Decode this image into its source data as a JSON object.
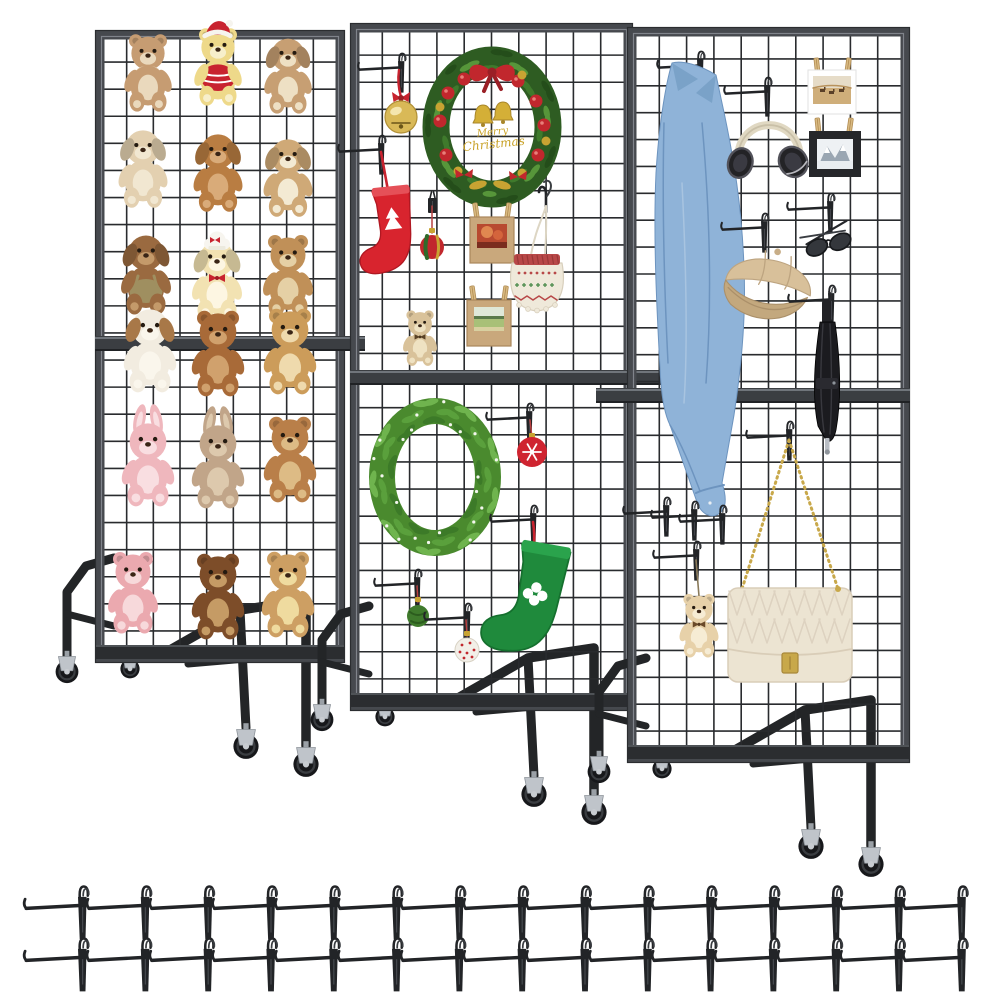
{
  "meta": {
    "description": "Product photo: three rolling grid-wall display panel stands with merchandise and two rows of grid hooks",
    "background": "#ffffff"
  },
  "colors": {
    "frame": "#46494e",
    "frame_hi": "#868b92",
    "frame_dark": "#2b2d30",
    "grid": "#292b2e",
    "bar": "#3b3e42",
    "bar_hi": "#70757b",
    "base": "#232527",
    "tire": "#17181b",
    "fork": "#bfc4ca",
    "hook": "#222427",
    "red": "#c8232f",
    "gold": "#c9a227",
    "denim": "#8fb3d8",
    "khaki": "#d8c09a",
    "cream_bag": "#ece4d2",
    "wreath_green": "#4a8a2e"
  },
  "stands": [
    {
      "name": "grid-panel-stand-left",
      "panel": {
        "x": 100,
        "y": 35,
        "w": 240,
        "h": 623,
        "midY": 336,
        "barEnd": 365
      },
      "items": [
        {
          "t": "plush",
          "n": "teddy-bear-tan",
          "kind": "bear",
          "p": [
            148,
            77
          ],
          "s": 0.95,
          "c": {
            "fur": "#c69c72",
            "muz": "#ead9bd"
          },
          "acc": {
            "ruff": "#ecdfc8"
          }
        },
        {
          "t": "plush",
          "n": "teddy-bear-yellow-santa",
          "kind": "bear",
          "p": [
            218,
            71
          ],
          "s": 0.95,
          "c": {
            "fur": "#eed98a",
            "muz": "#f7efcb"
          },
          "acc": {
            "hat": "santa",
            "sweater": "#c8232f"
          }
        },
        {
          "t": "plush",
          "n": "puppy-plush-light-brown",
          "kind": "dog",
          "p": [
            288,
            79
          ],
          "s": 0.95,
          "c": {
            "fur": "#c79f73",
            "muz": "#eee0c4"
          }
        },
        {
          "t": "plush",
          "n": "puppy-plush-cream",
          "kind": "dog",
          "p": [
            143,
            172
          ],
          "s": 0.98,
          "c": {
            "fur": "#e3d0b0",
            "muz": "#f1e7d1"
          }
        },
        {
          "t": "plush",
          "n": "puppy-plush-caramel",
          "kind": "dog",
          "p": [
            218,
            176
          ],
          "s": 0.98,
          "c": {
            "fur": "#b97d42",
            "muz": "#d9ab79"
          }
        },
        {
          "t": "plush",
          "n": "puppy-plush-tan",
          "kind": "dog",
          "p": [
            288,
            181
          ],
          "s": 0.98,
          "c": {
            "fur": "#cfa977",
            "muz": "#f3ead3"
          }
        },
        {
          "t": "plush",
          "n": "puppy-plush-overalls",
          "kind": "dog",
          "p": [
            146,
            278
          ],
          "s": 1.0,
          "c": {
            "fur": "#9a6a40",
            "muz": "#c49a6a"
          },
          "acc": {
            "overalls": "#9f8f60"
          }
        },
        {
          "t": "plush",
          "n": "puppy-plush-chef-hat",
          "kind": "dog",
          "p": [
            217,
            284
          ],
          "s": 1.0,
          "c": {
            "fur": "#f2e2b2",
            "muz": "#fdf6e2"
          },
          "acc": {
            "hat": "chef",
            "bowtie": "#c8232f"
          }
        },
        {
          "t": "plush",
          "n": "teddy-bear-caramel",
          "kind": "bear",
          "p": [
            288,
            280
          ],
          "s": 1.0,
          "c": {
            "fur": "#c09058",
            "muz": "#e5d0a5"
          }
        },
        {
          "t": "plush",
          "n": "puppy-plush-white",
          "kind": "dog",
          "p": [
            150,
            354
          ],
          "s": 1.05,
          "c": {
            "fur": "#f2ece0",
            "muz": "#faf6ec",
            "ear": "#a87848"
          }
        },
        {
          "t": "plush",
          "n": "teddy-bear-brown",
          "kind": "bear",
          "p": [
            218,
            358
          ],
          "s": 1.05,
          "c": {
            "fur": "#a86a38",
            "muz": "#d0a16d"
          }
        },
        {
          "t": "plush",
          "n": "teddy-bear-golden",
          "kind": "bear",
          "p": [
            290,
            356
          ],
          "s": 1.05,
          "c": {
            "fur": "#cc9c5a",
            "muz": "#efdaad"
          }
        },
        {
          "t": "plush",
          "n": "bunny-plush-pink",
          "kind": "bunny",
          "p": [
            148,
            468
          ],
          "s": 1.05,
          "c": {
            "fur": "#efb7bd",
            "muz": "#f9dee1"
          }
        },
        {
          "t": "plush",
          "n": "bunny-plush-taupe",
          "kind": "bunny",
          "p": [
            218,
            470
          ],
          "s": 1.05,
          "c": {
            "fur": "#c1a589",
            "muz": "#ddc9ad"
          }
        },
        {
          "t": "plush",
          "n": "teddy-bear-russet",
          "kind": "bear",
          "p": [
            290,
            464
          ],
          "s": 1.05,
          "c": {
            "fur": "#b97f49",
            "muz": "#ddbb85"
          }
        },
        {
          "t": "plush",
          "n": "teddy-bear-pink",
          "kind": "bear",
          "p": [
            133,
            597
          ],
          "s": 1.0,
          "c": {
            "fur": "#eba9af",
            "muz": "#f7d9db"
          }
        },
        {
          "t": "plush",
          "n": "teddy-bear-dark-brown",
          "kind": "bear",
          "p": [
            218,
            601
          ],
          "s": 1.05,
          "c": {
            "fur": "#7d4d29",
            "muz": "#c59b65"
          }
        },
        {
          "t": "plush",
          "n": "teddy-bear-honey",
          "kind": "bear",
          "p": [
            288,
            599
          ],
          "s": 1.05,
          "c": {
            "fur": "#cd9f63",
            "muz": "#efdb9f"
          }
        }
      ]
    },
    {
      "name": "grid-panel-stand-middle",
      "panel": {
        "x": 355,
        "y": 28,
        "w": 273,
        "h": 678,
        "midY": 370,
        "barEnd": 703
      },
      "items": [
        {
          "t": "hook",
          "n": "grid-hook",
          "p": [
            398,
            62
          ]
        },
        {
          "t": "bell",
          "n": "gold-jingle-bell",
          "p": [
            401,
            117
          ],
          "anchor": [
            399,
            70
          ]
        },
        {
          "t": "wreath-xmas",
          "n": "christmas-wreath",
          "p": [
            492,
            127
          ],
          "text": [
            "Merry",
            "Christmas"
          ]
        },
        {
          "t": "hook",
          "n": "grid-hook",
          "p": [
            378,
            144
          ]
        },
        {
          "t": "ribbon",
          "n": "red-ribbon",
          "from": [
            381,
            152
          ],
          "to": [
            389,
            196
          ]
        },
        {
          "t": "stocking",
          "n": "red-christmas-stocking",
          "p": [
            391,
            236
          ],
          "s": 1.1,
          "rot": -6,
          "c": {
            "body": "#d8242e",
            "cuff": "#e55058",
            "line": "#b01822"
          },
          "cut": "tree"
        },
        {
          "t": "clip",
          "n": "grid-clip",
          "p": [
            428,
            198
          ]
        },
        {
          "t": "ornament-striped",
          "n": "striped-ornament",
          "p": [
            432,
            247
          ],
          "anchor": [
            432,
            206
          ]
        },
        {
          "t": "photo-frame",
          "n": "kraft-photo-frame-autumn",
          "p": [
            492,
            240
          ],
          "photo": "autumn"
        },
        {
          "t": "s-hook",
          "n": "s-hook",
          "p": [
            546,
            198
          ]
        },
        {
          "t": "knit-bag",
          "n": "knit-drawstring-bag",
          "p": [
            537,
            283
          ]
        },
        {
          "t": "plush",
          "n": "mini-teddy-bear",
          "kind": "bear",
          "p": [
            420,
            341
          ],
          "s": 0.68,
          "c": {
            "fur": "#d9c29a",
            "muz": "#efe2c2"
          },
          "acc": {
            "bowtie": "#5a4226"
          }
        },
        {
          "t": "photo-frame",
          "n": "kraft-photo-frame-field",
          "p": [
            489,
            323
          ],
          "photo": "field"
        },
        {
          "t": "wreath-green",
          "n": "green-leaf-wreath",
          "p": [
            435,
            477
          ]
        },
        {
          "t": "hook",
          "n": "grid-hook",
          "p": [
            526,
            412
          ]
        },
        {
          "t": "ornament-snow",
          "n": "red-snowflake-ornament",
          "p": [
            532,
            452
          ],
          "anchor": [
            530,
            420
          ]
        },
        {
          "t": "hook",
          "n": "grid-hook",
          "p": [
            530,
            514
          ]
        },
        {
          "t": "ribbon",
          "n": "red-ribbon",
          "from": [
            533,
            522
          ],
          "to": [
            528,
            572
          ]
        },
        {
          "t": "stocking",
          "n": "green-christmas-stocking",
          "p": [
            530,
            607
          ],
          "s": 1.45,
          "rot": 10,
          "c": {
            "body": "#1f8a3c",
            "cuff": "#2aa34c",
            "line": "#15702e"
          },
          "cut": "clover"
        },
        {
          "t": "hook",
          "n": "grid-hook",
          "p": [
            414,
            578
          ]
        },
        {
          "t": "ornament-plain",
          "n": "green-ball-ornament",
          "p": [
            418,
            616
          ],
          "anchor": [
            417,
            586
          ]
        },
        {
          "t": "hook",
          "n": "grid-hook",
          "p": [
            464,
            612
          ]
        },
        {
          "t": "ornament-dots",
          "n": "white-red-dot-ornament",
          "p": [
            467,
            650
          ],
          "anchor": [
            466,
            620
          ]
        }
      ]
    },
    {
      "name": "grid-panel-stand-right",
      "panel": {
        "x": 632,
        "y": 32,
        "w": 273,
        "h": 726,
        "midY": 388,
        "barStart": 596
      },
      "items": [
        {
          "t": "hook",
          "n": "grid-hook",
          "p": [
            697,
            60
          ]
        },
        {
          "t": "denim-shirt",
          "n": "denim-shirt",
          "p": [
            672,
            63
          ]
        },
        {
          "t": "hook",
          "n": "grid-hook",
          "p": [
            764,
            86
          ]
        },
        {
          "t": "headphones",
          "n": "headphones",
          "p": [
            769,
            132
          ],
          "s": 1.15
        },
        {
          "t": "photo-card",
          "n": "photo-card-desert",
          "p": [
            832,
            92
          ]
        },
        {
          "t": "photo-black",
          "n": "framed-photo-mountain",
          "p": [
            835,
            154
          ]
        },
        {
          "t": "hook",
          "n": "grid-hook",
          "p": [
            827,
            202
          ]
        },
        {
          "t": "sunglasses",
          "n": "sunglasses",
          "p": [
            828,
            243
          ]
        },
        {
          "t": "hook",
          "n": "grid-hook",
          "p": [
            761,
            222
          ]
        },
        {
          "t": "cap",
          "n": "baseball-cap",
          "p": [
            770,
            276
          ],
          "s": 1.1
        },
        {
          "t": "hook",
          "n": "grid-hook",
          "p": [
            828,
            294
          ]
        },
        {
          "t": "umbrella",
          "n": "folded-umbrella",
          "p": [
            827,
            382
          ]
        },
        {
          "t": "hook",
          "n": "grid-hook",
          "p": [
            663,
            506
          ]
        },
        {
          "t": "hook",
          "n": "grid-hook",
          "p": [
            691,
            510
          ]
        },
        {
          "t": "hook",
          "n": "grid-hook",
          "p": [
            719,
            514
          ]
        },
        {
          "t": "hook",
          "n": "grid-hook",
          "p": [
            693,
            550
          ]
        },
        {
          "t": "plush",
          "n": "teddy-bear-keychain",
          "kind": "bear",
          "p": [
            699,
            629
          ],
          "s": 0.78,
          "c": {
            "fur": "#e7d1a9",
            "muz": "#f6ecd4"
          },
          "acc": {
            "bowtie": "#6a4a2a"
          },
          "string": [
            696,
            560
          ]
        },
        {
          "t": "hook",
          "n": "grid-hook",
          "p": [
            786,
            430
          ]
        },
        {
          "t": "handbag",
          "n": "quilted-handbag",
          "p": [
            790,
            635
          ],
          "anchor": [
            789,
            440
          ]
        }
      ]
    }
  ],
  "hook_rows": [
    {
      "y": 898,
      "x0": 78,
      "dx": 62.8,
      "count": 15,
      "s": 1.15
    },
    {
      "y": 950,
      "x0": 78,
      "dx": 62.8,
      "count": 15,
      "s": 1.15
    }
  ]
}
